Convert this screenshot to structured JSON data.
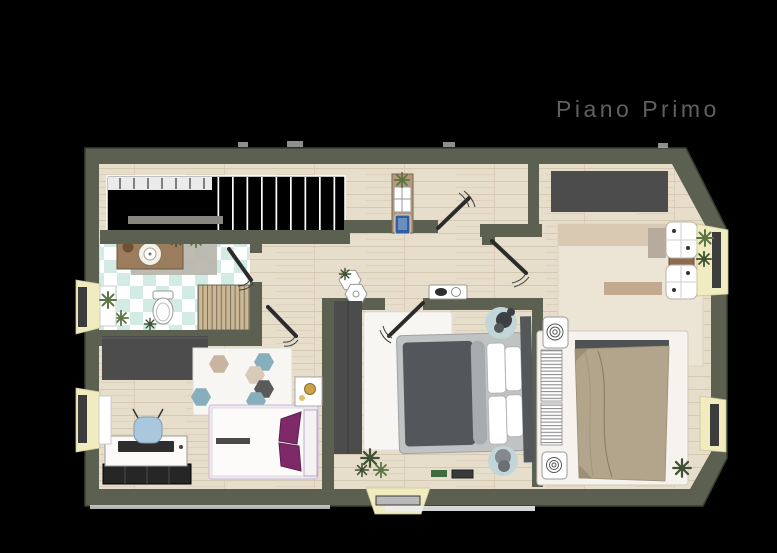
{
  "title": "Piano Primo",
  "palette": {
    "black": "#000000",
    "wall": "#5b6051",
    "wallEdge": "#3a3f31",
    "wood": "#e7ddcb",
    "grain": "#d2c4ac",
    "tileB": "#d2ebe4",
    "sill": "#f1ecc0",
    "frame": "#3c3c3c",
    "wardrobe": "#4c4c4c",
    "bedDark": "#53575b",
    "bedMid": "#bfc3c3",
    "tanBed": "#b2a58b",
    "purple": "#7e2a68",
    "chairBlue": "#a9c7dd",
    "matBlue": "#c2d5d8",
    "rugWhite": "#f7f6f3",
    "rugCream": "#ece4d4",
    "hexBlue": "#87aebc",
    "hexTan": "#c9b4a0",
    "hexDark": "#5a5a5a",
    "plantDark": "#3f5233",
    "plantLight": "#5c7544",
    "vanity": "#9b7d5d",
    "slatTan": "#cbb795",
    "slatLine": "#7a6f57",
    "titleColor": "#606060",
    "white": "#ffffff"
  }
}
